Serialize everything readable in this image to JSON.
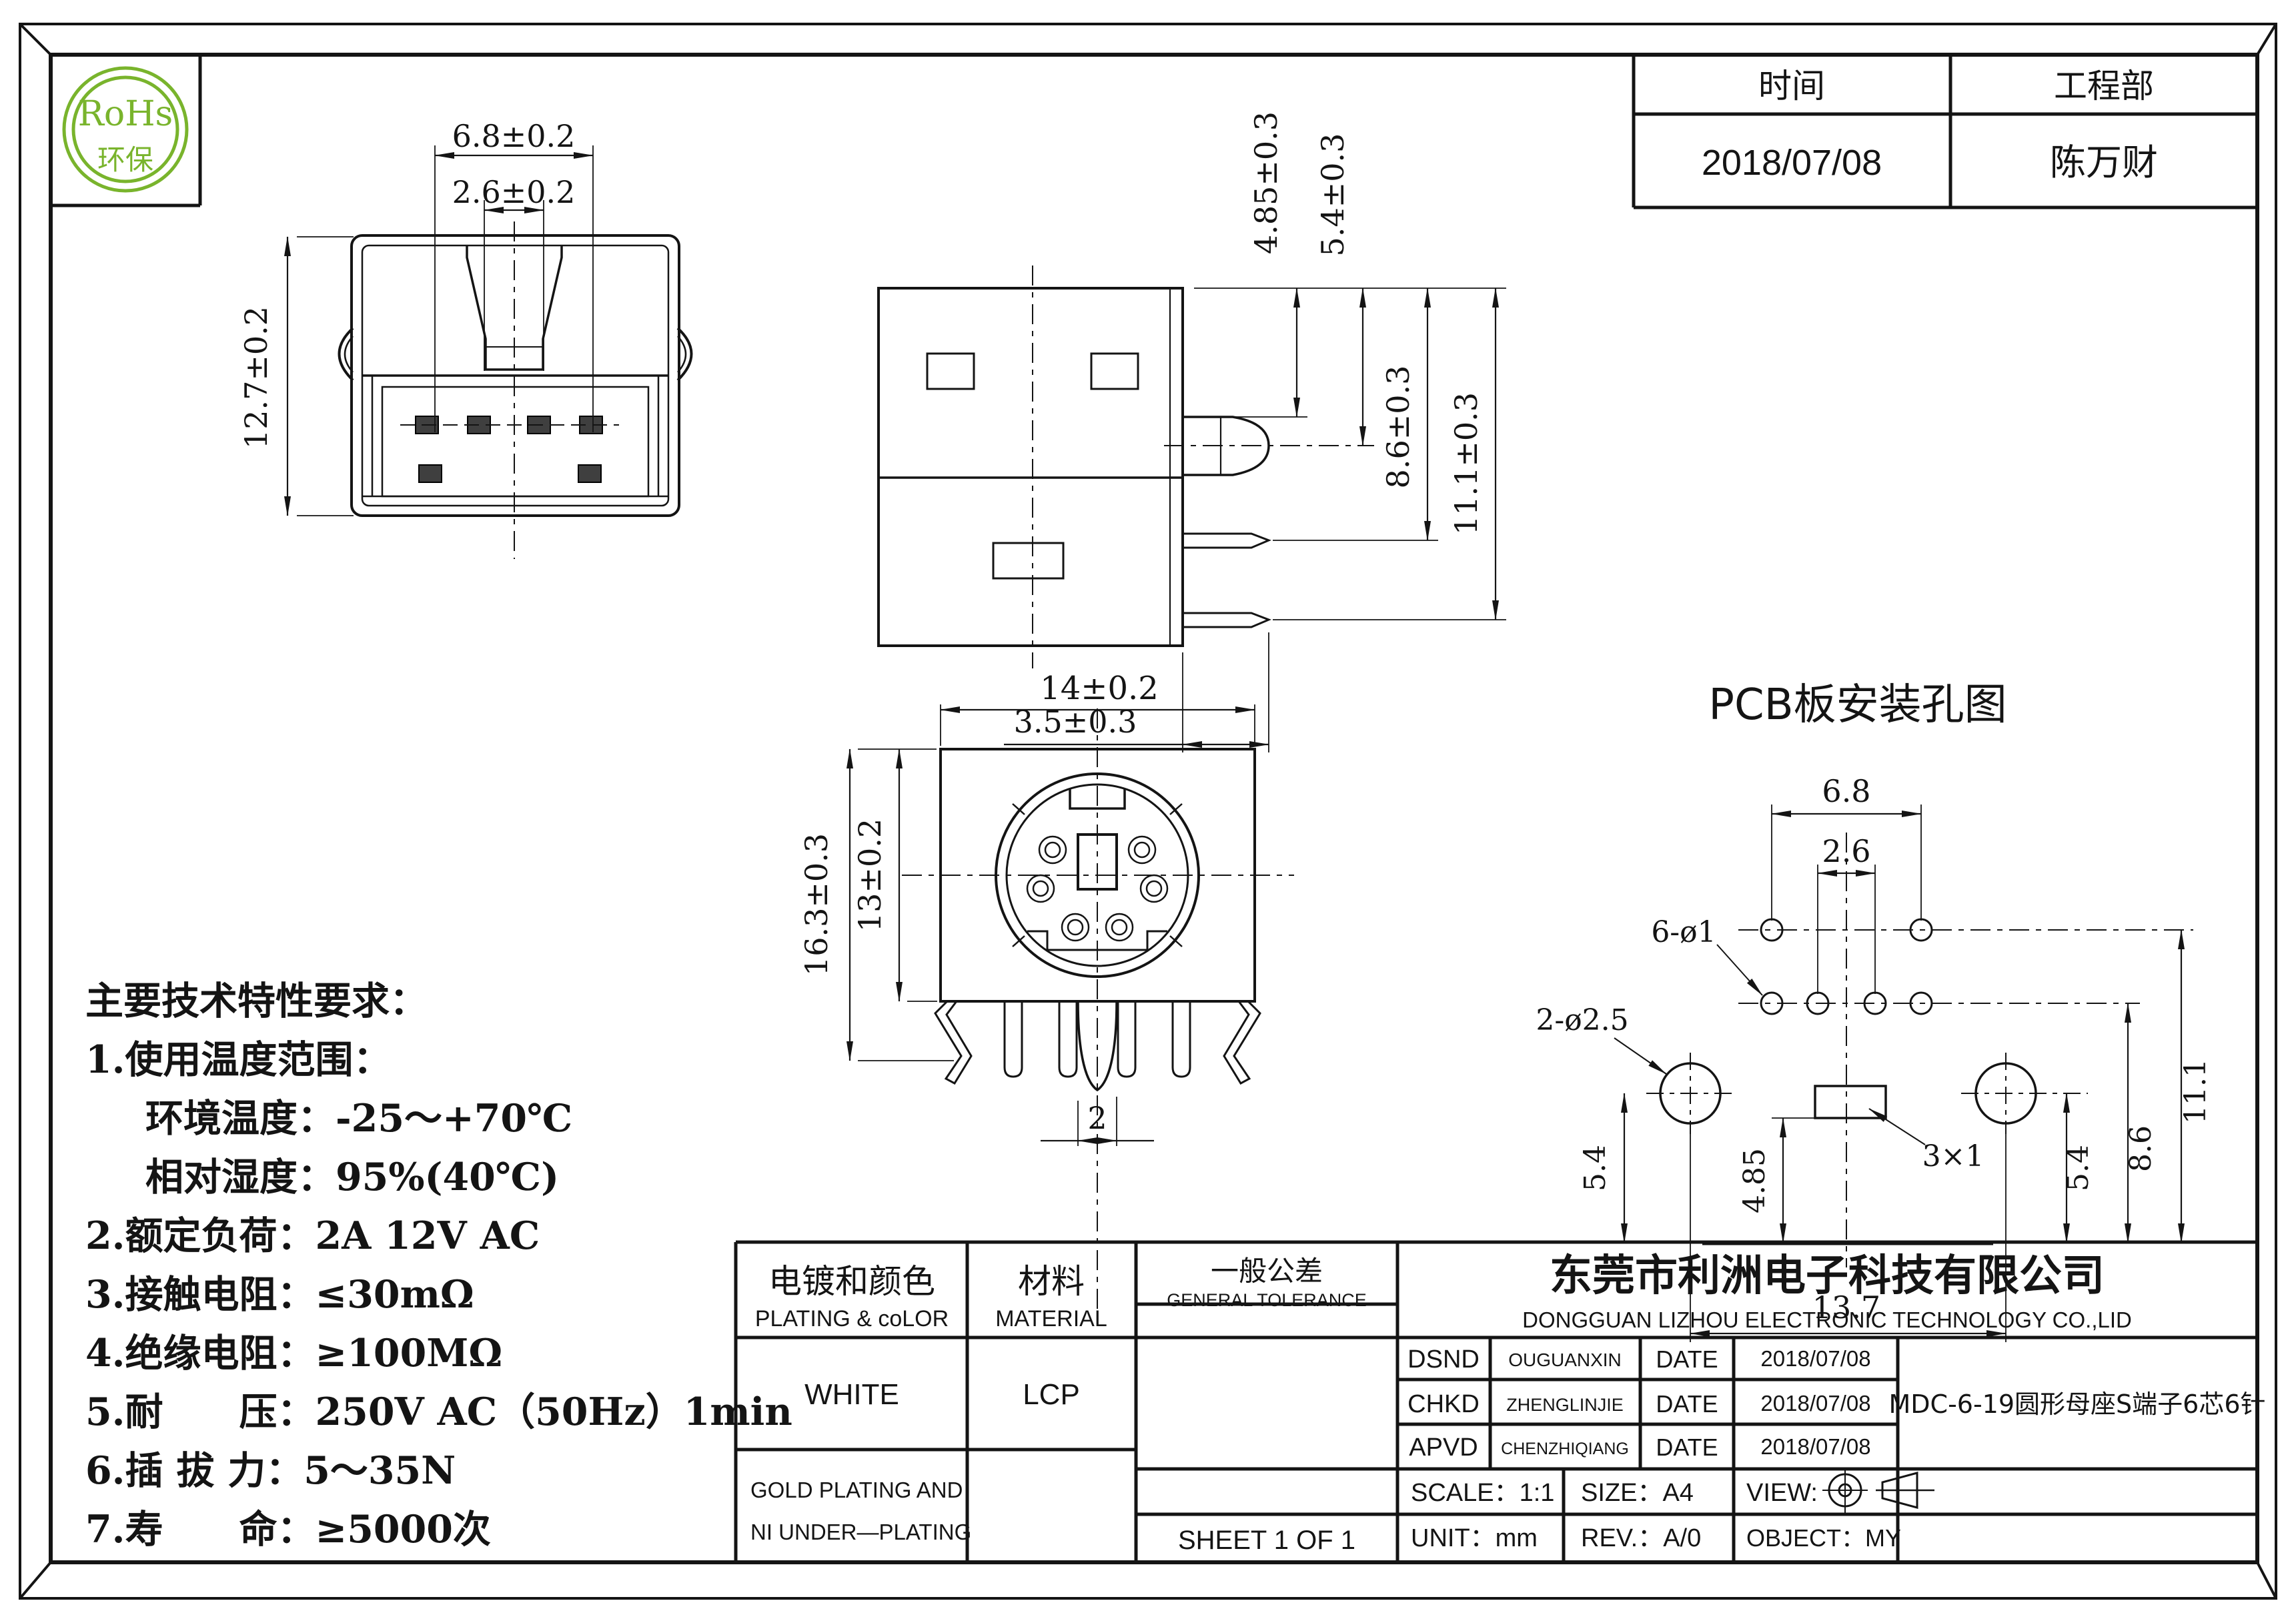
{
  "logo": {
    "line1": "RoHs",
    "line2": "环保",
    "color": "#79b42c"
  },
  "header_table": {
    "time_label": "时间",
    "dept_label": "工程部",
    "time_value": "2018/07/08",
    "dept_value": "陈万财"
  },
  "views": {
    "rear": {
      "width": "6.8±0.2",
      "inner_width": "2.6±0.2",
      "height": "12.7±0.2"
    },
    "side": {
      "peg_top": "4.85±0.3",
      "peg_center": "5.4±0.3",
      "pin1": "8.6±0.3",
      "pin2": "11.1±0.3",
      "depth": "3.5±0.3"
    },
    "front": {
      "width": "14±0.2",
      "outer_height": "16.3±0.3",
      "inner_height": "13±0.2",
      "pin_width": "2"
    },
    "pcb": {
      "title": "PCB板安装孔图",
      "hole_span": "6.8",
      "hole_pitch": "2.6",
      "small_holes": "6-ø1",
      "big_holes": "2-ø2.5",
      "left_offset": "5.4",
      "slot_offset": "4.85",
      "slot_size": "3×1",
      "right_offset": "5.4",
      "row2_offset": "8.6",
      "row1_offset": "11.1",
      "big_span": "13.7"
    }
  },
  "tech_specs": {
    "title": "主要技术特性要求：",
    "lines": [
      "1.使用温度范围：",
      "环境温度：-25～+70℃",
      "相对湿度：95%(40℃)",
      "2.额定负荷：2A 12V AC",
      "3.接触电阻：≤30mΩ",
      "4.绝缘电阻：≥100MΩ",
      "5.耐　　压：250V AC（50Hz）1min",
      "6.插 拔 力：5～35N",
      "7.寿　　命：≥5000次"
    ]
  },
  "title_block": {
    "plating_header_cn": "电镀和颜色",
    "plating_header_en": "PLATING & coLOR",
    "material_header_cn": "材料",
    "material_header_en": "MATERIAL",
    "tolerance_header_cn": "一般公差",
    "tolerance_header_en": "GENERAL TOLERANCE",
    "plating_value": "WHITE",
    "material_value": "LCP",
    "plating_note_line1": "GOLD PLATING AND",
    "plating_note_line2": "NI UNDER—PLATING",
    "sheet": "SHEET 1 OF 1",
    "company_cn": "东莞市利洲电子科技有限公司",
    "company_en": "DONGGUAN LIZHOU ELECTRONIC TECHNOLOGY CO.,LID",
    "rows": [
      {
        "role": "DSND",
        "name": "OUGUANXIN",
        "date_label": "DATE",
        "date": "2018/07/08"
      },
      {
        "role": "CHKD",
        "name": "ZHENGLINJIE",
        "date_label": "DATE",
        "date": "2018/07/08"
      },
      {
        "role": "APVD",
        "name": "CHENZHIQIANG",
        "date_label": "DATE",
        "date": "2018/07/08"
      }
    ],
    "part_name": "MDC-6-19圆形母座S端子6芯6针",
    "scale": "SCALE：1:1",
    "size": "SIZE：A4",
    "view_label": "VIEW:",
    "unit": "UNIT：mm",
    "rev": "REV.：A/0",
    "object": "OBJECT：MY"
  }
}
